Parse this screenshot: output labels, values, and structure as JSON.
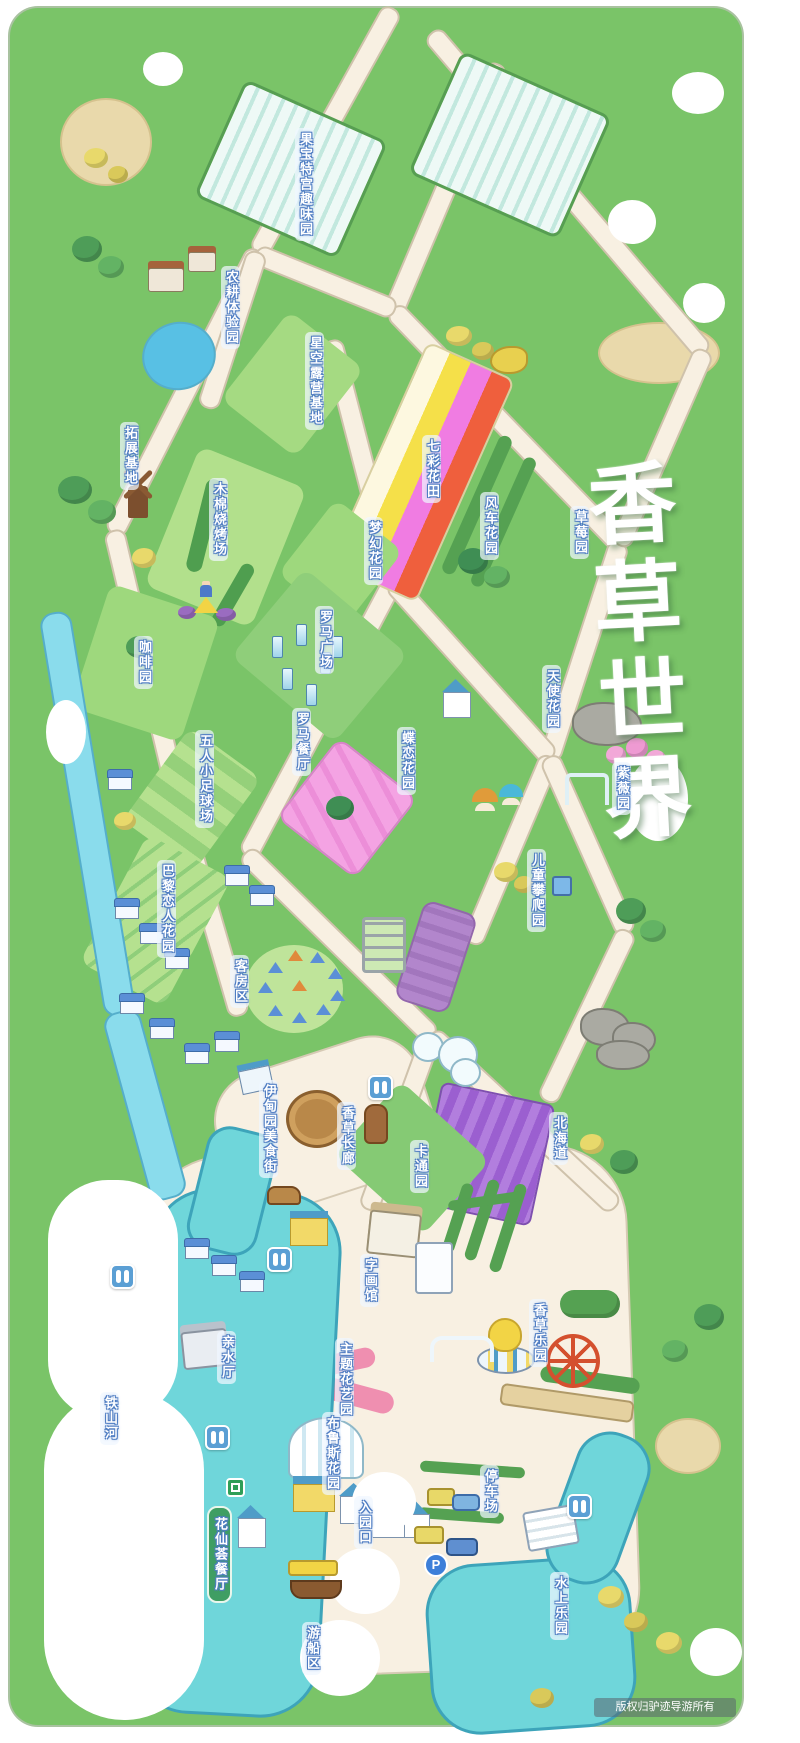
{
  "title": {
    "text": "香草世界"
  },
  "copyright": {
    "text": "版权归驴迹导游所有"
  },
  "icons": {
    "parking_label": "P"
  },
  "colors": {
    "map_green": "#7ac468",
    "road_cream": "#f8f0e2",
    "water_teal": "#6fd6da",
    "river_blue": "#8adcec",
    "label_outline_blue": "#4e7cc2",
    "lavender": "#9b63cf",
    "rainbow_stripes": [
      "#fdf8e0",
      "#f5e049",
      "#f07ce2",
      "#ef5f3d"
    ],
    "pink_field": "#f4a3e3"
  },
  "labels": [
    {
      "id": "guobao-fun-garden",
      "text": "果宝特宫趣味园"
    },
    {
      "id": "farming-experience",
      "text": "农耕体验园"
    },
    {
      "id": "starry-camping-base",
      "text": "星空露营基地"
    },
    {
      "id": "expansion-base",
      "text": "拓展基地"
    },
    {
      "id": "rainbow-flower-field",
      "text": "七彩花田"
    },
    {
      "id": "windmill-garden",
      "text": "风车花园"
    },
    {
      "id": "strawberry-garden",
      "text": "草莓园"
    },
    {
      "id": "kapok-bbq",
      "text": "木棉烧烤场"
    },
    {
      "id": "dream-garden",
      "text": "梦幻花园"
    },
    {
      "id": "coffee-garden",
      "text": "咖啡园"
    },
    {
      "id": "roman-plaza",
      "text": "罗马广场"
    },
    {
      "id": "angel-garden",
      "text": "天使花园"
    },
    {
      "id": "roman-restaurant",
      "text": "罗马餐厅"
    },
    {
      "id": "butterfly-garden",
      "text": "蝶恋花园"
    },
    {
      "id": "crape-myrtle-garden",
      "text": "紫薇园"
    },
    {
      "id": "five-a-side-soccer",
      "text": "五人小足球场"
    },
    {
      "id": "kids-climbing-garden",
      "text": "儿童攀爬园"
    },
    {
      "id": "paris-lovers-garden",
      "text": "巴黎恋人花园"
    },
    {
      "id": "guest-room-area",
      "text": "客房区"
    },
    {
      "id": "eden-food-street",
      "text": "伊甸园美食街"
    },
    {
      "id": "vanilla-corridor",
      "text": "香草长廊"
    },
    {
      "id": "cartoon-garden",
      "text": "卡通园"
    },
    {
      "id": "hokkaido",
      "text": "北海道"
    },
    {
      "id": "calligraphy-gallery",
      "text": "字画馆"
    },
    {
      "id": "vanilla-park",
      "text": "香草乐园"
    },
    {
      "id": "waterfront-hall",
      "text": "亲水厅"
    },
    {
      "id": "theme-floral-garden",
      "text": "主题花艺园"
    },
    {
      "id": "bruce-garden",
      "text": "布鲁斯花园"
    },
    {
      "id": "tieshan-river",
      "text": "铁山河"
    },
    {
      "id": "flower-fairy-restaurant",
      "text": "花仙荟餐厅"
    },
    {
      "id": "entrance",
      "text": "入园口"
    },
    {
      "id": "parking-lot",
      "text": "停车场"
    },
    {
      "id": "water-park",
      "text": "水上乐园"
    },
    {
      "id": "boating-area",
      "text": "游船区"
    }
  ]
}
